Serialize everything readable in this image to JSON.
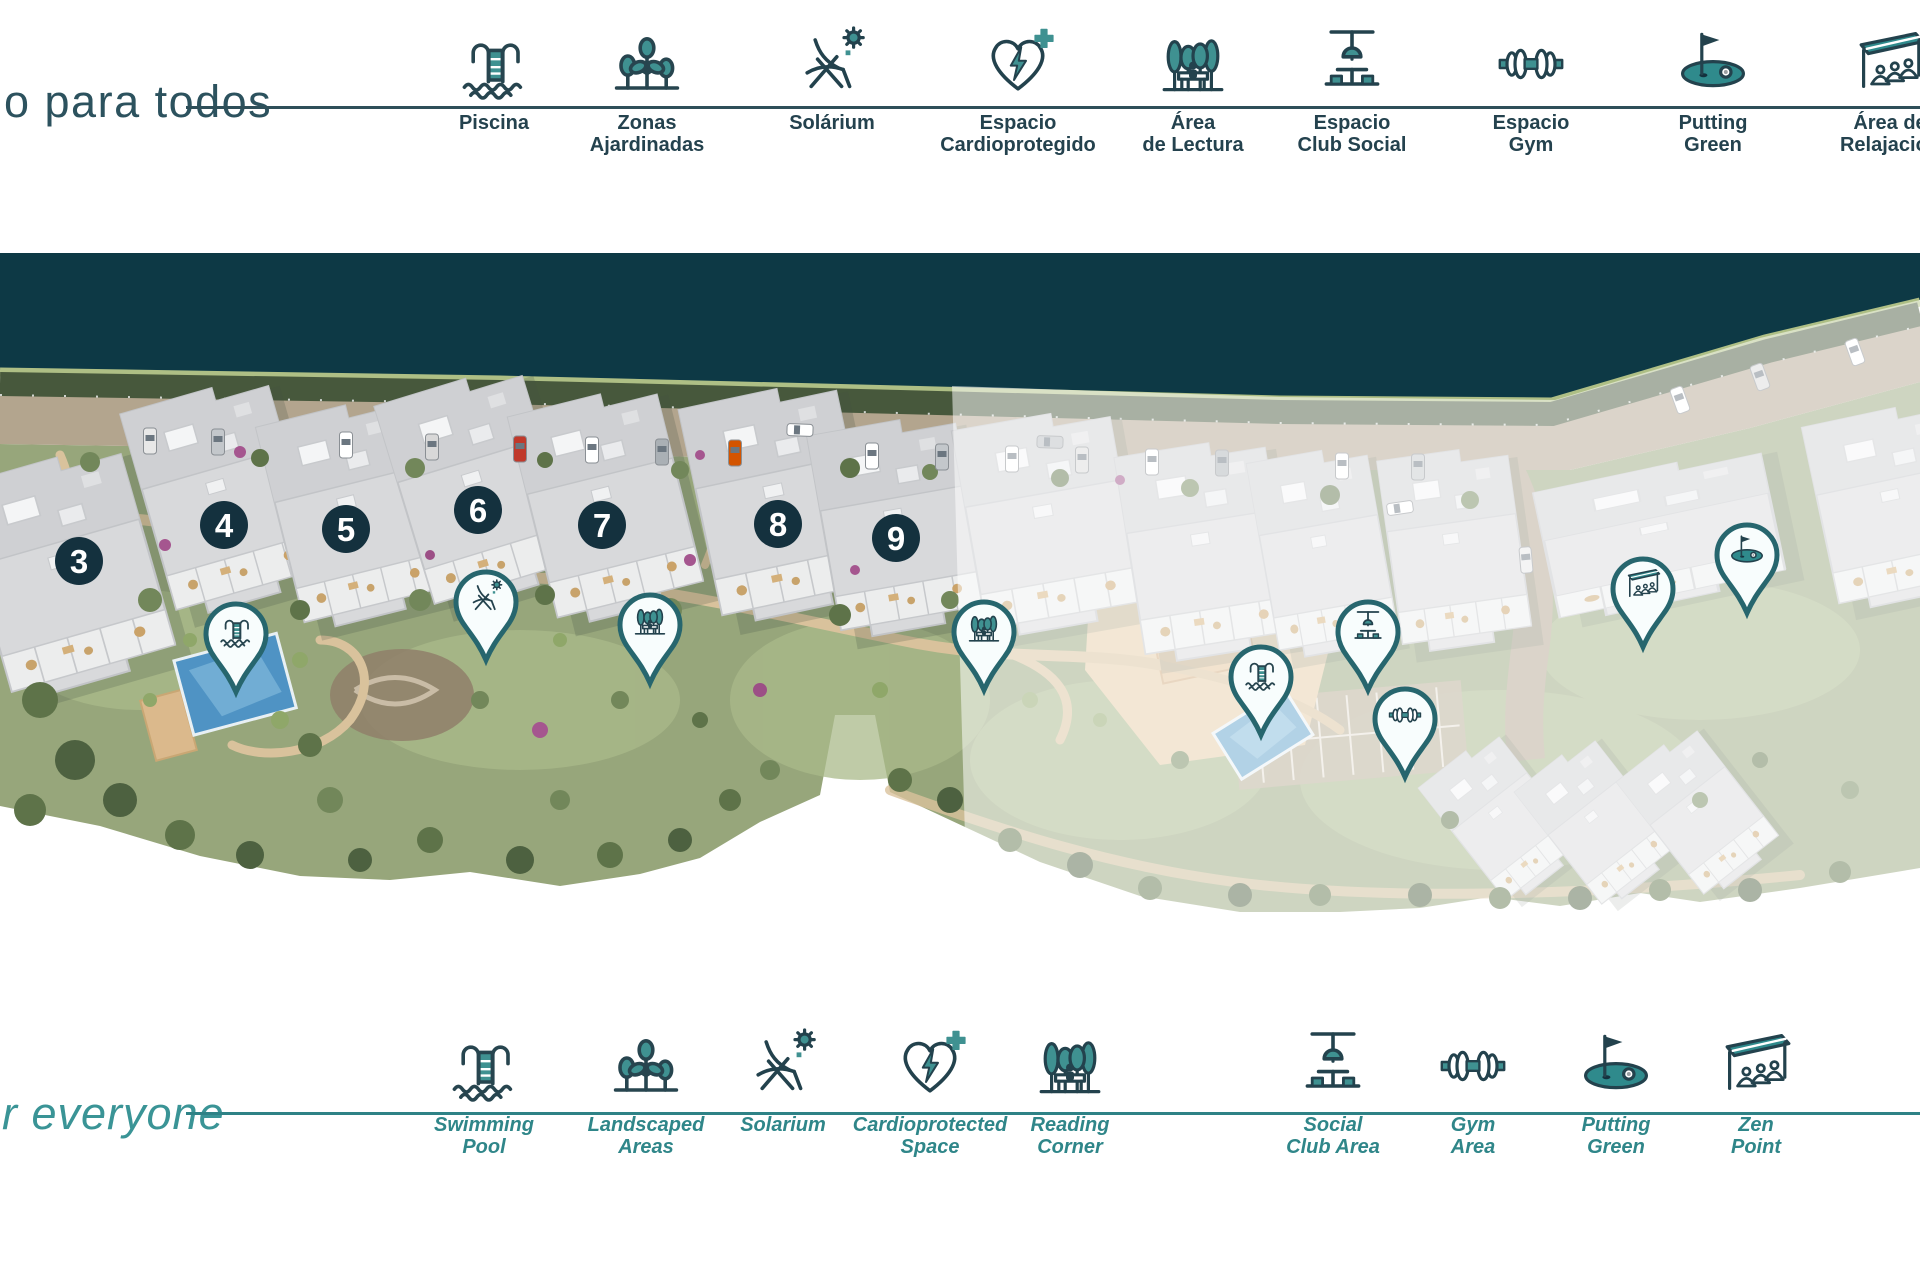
{
  "colors": {
    "accent_teal": "#348a8c",
    "icon_outline_navy": "#27454f",
    "dark_band": "#0d3945",
    "marker_circle": "#14313e",
    "pin_ring": "#276a72",
    "top_label": "#24424e",
    "bottom_label": "#2f8689"
  },
  "legend_top": {
    "heading": "o para todos",
    "items": [
      {
        "icon": "pool-icon",
        "lines": [
          "Piscina"
        ],
        "x": 494
      },
      {
        "icon": "plants-icon",
        "lines": [
          "Zonas",
          "Ajardinadas"
        ],
        "x": 647
      },
      {
        "icon": "solarium-icon",
        "lines": [
          "Solárium"
        ],
        "x": 832
      },
      {
        "icon": "cardio-icon",
        "lines": [
          "Espacio",
          "Cardioprotegido"
        ],
        "x": 1018
      },
      {
        "icon": "reading-icon",
        "lines": [
          "Área",
          "de Lectura"
        ],
        "x": 1193
      },
      {
        "icon": "social-icon",
        "lines": [
          "Espacio",
          "Club Social"
        ],
        "x": 1352
      },
      {
        "icon": "gym-icon",
        "lines": [
          "Espacio",
          "Gym"
        ],
        "x": 1531
      },
      {
        "icon": "golf-icon",
        "lines": [
          "Putting",
          "Green"
        ],
        "x": 1713
      },
      {
        "icon": "zen-icon",
        "lines": [
          "Área de",
          "Relajación"
        ],
        "x": 1890
      }
    ]
  },
  "legend_bottom": {
    "heading": "r everyone",
    "items": [
      {
        "icon": "pool-icon",
        "lines": [
          "Swimming",
          "Pool"
        ],
        "x": 484
      },
      {
        "icon": "plants-icon",
        "lines": [
          "Landscaped",
          "Areas"
        ],
        "x": 646
      },
      {
        "icon": "solarium-icon",
        "lines": [
          "Solarium"
        ],
        "x": 783
      },
      {
        "icon": "cardio-icon",
        "lines": [
          "Cardioprotected",
          "Space"
        ],
        "x": 930
      },
      {
        "icon": "reading-icon",
        "lines": [
          "Reading",
          "Corner"
        ],
        "x": 1070
      },
      {
        "icon": "social-icon",
        "lines": [
          "Social",
          "Club Area"
        ],
        "x": 1333
      },
      {
        "icon": "gym-icon",
        "lines": [
          "Gym",
          "Area"
        ],
        "x": 1473
      },
      {
        "icon": "golf-icon",
        "lines": [
          "Putting",
          "Green"
        ],
        "x": 1616
      },
      {
        "icon": "zen-icon",
        "lines": [
          "Zen",
          "Point"
        ],
        "x": 1756
      }
    ]
  },
  "map": {
    "building_markers": [
      {
        "label": "3",
        "x": 79,
        "y": 561
      },
      {
        "label": "4",
        "x": 224,
        "y": 525
      },
      {
        "label": "5",
        "x": 346,
        "y": 529
      },
      {
        "label": "6",
        "x": 478,
        "y": 510
      },
      {
        "label": "7",
        "x": 602,
        "y": 525
      },
      {
        "label": "8",
        "x": 778,
        "y": 524
      },
      {
        "label": "9",
        "x": 896,
        "y": 538
      }
    ],
    "amenity_pins": [
      {
        "icon": "pool-icon",
        "x": 236,
        "y": 692
      },
      {
        "icon": "solarium-icon",
        "x": 486,
        "y": 660
      },
      {
        "icon": "reading-icon",
        "x": 650,
        "y": 683
      },
      {
        "icon": "reading-icon",
        "x": 984,
        "y": 690
      },
      {
        "icon": "pool-icon",
        "x": 1261,
        "y": 735
      },
      {
        "icon": "social-icon",
        "x": 1368,
        "y": 690
      },
      {
        "icon": "gym-icon",
        "x": 1405,
        "y": 777
      },
      {
        "icon": "zen-icon",
        "x": 1643,
        "y": 647
      },
      {
        "icon": "golf-icon",
        "x": 1747,
        "y": 613
      }
    ]
  }
}
